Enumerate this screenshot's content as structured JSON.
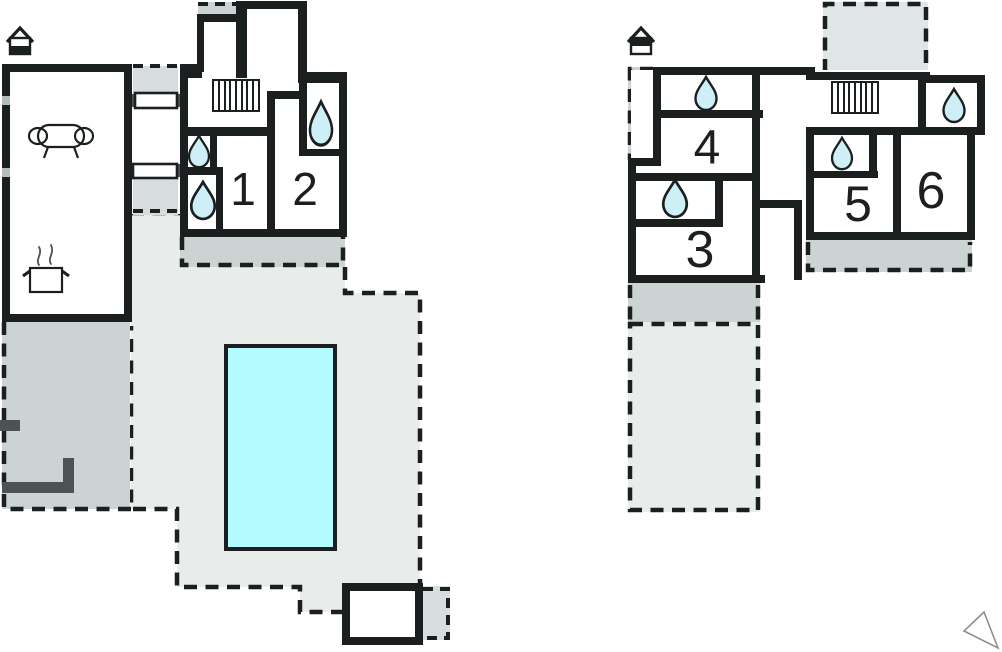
{
  "ground_floor": {
    "marker_icon": "house-ground-floor",
    "rooms": {
      "r1": "1",
      "r2": "2"
    },
    "features": {
      "sofa": "sofa-icon",
      "stove": "cooking-pot-icon",
      "stairs": "stairs-icon",
      "pool": "swimming-pool",
      "water_drop_count": 3,
      "annex": "pool-house",
      "terraces": "dashed-terrace-areas"
    }
  },
  "upper_floor": {
    "marker_icon": "house-upper-floor",
    "rooms": {
      "r3": "3",
      "r4": "4",
      "r5": "5",
      "r6": "6"
    },
    "features": {
      "stairs": "stairs-icon",
      "water_drop_count": 4,
      "balcony": "dashed-balcony-area",
      "terraces": "dashed-terrace-areas"
    }
  },
  "compass": {
    "icon": "north-arrow"
  },
  "colors": {
    "wall": "#1b1f20",
    "terrace": "#ccd4d3",
    "patio": "#e8edec",
    "balcony": "#e0e6e5",
    "patch": "#d7dddc",
    "pool": "#b4fbff",
    "drop": "#cdeff5",
    "darkwall": "#4d5355",
    "outline": "#98a2a1"
  }
}
